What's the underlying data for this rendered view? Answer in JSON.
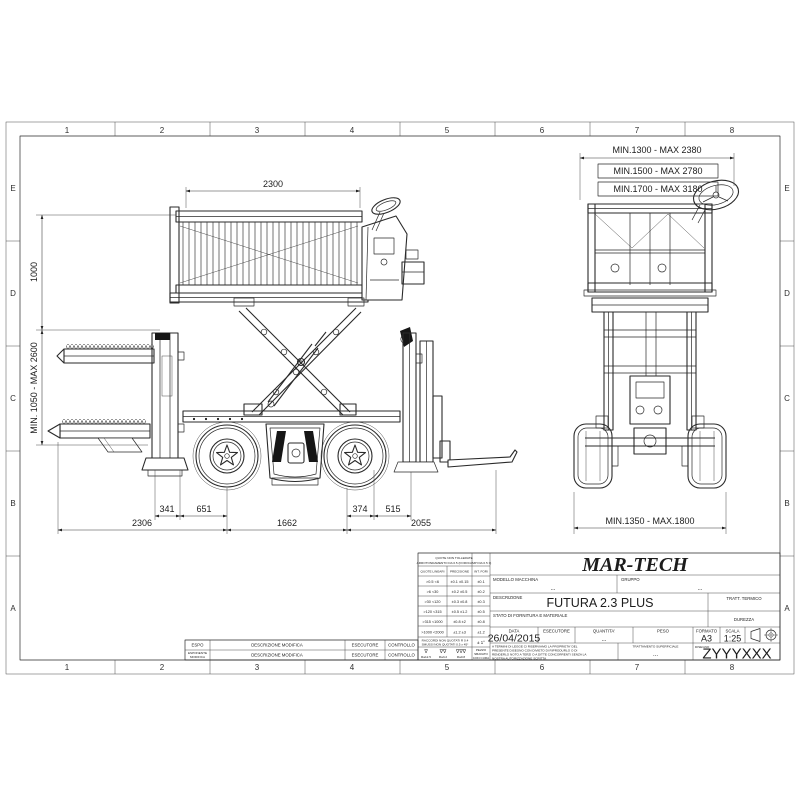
{
  "colors": {
    "line": "#2a2a2a",
    "background": "#ffffff",
    "dark_fill": "#161616"
  },
  "frame": {
    "columns": [
      "1",
      "2",
      "3",
      "4",
      "5",
      "6",
      "7",
      "8"
    ],
    "rows": [
      "E",
      "D",
      "C",
      "B",
      "A"
    ]
  },
  "side_view": {
    "dim_top": "2300",
    "dim_height_upper": "1000",
    "dim_height_lower": "MIN. 1050 - MAX 2600",
    "dim_341": "341",
    "dim_651": "651",
    "dim_374": "374",
    "dim_515": "515",
    "dim_2306": "2306",
    "dim_1662": "1662",
    "dim_2055": "2055"
  },
  "front_view": {
    "dim_top_1": "MIN.1300 - MAX 2380",
    "dim_top_2": "MIN.1500 - MAX 2780",
    "dim_top_3": "MIN.1700 - MAX 3180",
    "dim_bottom": "MIN.1350 - MAX.1800"
  },
  "revision_table": {
    "col_espo": "ESPO",
    "col_espo_sub1": "ESPONENTE",
    "col_espo_sub2": "MODIFICA",
    "col_desc": "DESCRIZIONE MODIFICA",
    "col_exec": "ESECUTORE",
    "col_ctrl": "CONTROLLO"
  },
  "tolerance_table": {
    "header_line1": "QUOTE NON TOLLERATE",
    "header_line2": "ARROTONDAMENTO DA 0.5 (FORI/CAMPI DA 0.5 ±)",
    "col_linear": "QUOTE LINEARI",
    "col_precision": "PRECISIONE",
    "col_holes": "INT. FORI",
    "rows": [
      {
        "range": ">0.5  <6",
        "prec": "±0.1  ±0.15",
        "fori": "±0.1"
      },
      {
        "range": ">6  <30",
        "prec": "±0.2  ±0.5",
        "fori": "±0.2"
      },
      {
        "range": ">30  <120",
        "prec": "±0.3  ±0.8",
        "fori": "±0.3"
      },
      {
        "range": ">120  <315",
        "prec": "±0.5  ±1.2",
        "fori": "±0.5"
      },
      {
        "range": ">315 <1000",
        "prec": "±0.8  ±2",
        "fori": "±0.8"
      },
      {
        "range": ">1000 <2000",
        "prec": "±1.2  ±3",
        "fori": "±1.2"
      }
    ],
    "raccordi_line1": "RACCORDI NON QUOTATI R 0.4",
    "raccordi_line2": "SMUSSI NON QUOTATI 0.5 x 45°",
    "angles_value": "± 1°",
    "roughness": [
      {
        "symbol": "∇",
        "value": "Ra12.5"
      },
      {
        "symbol": "∇∇",
        "value": "Ra3.2"
      },
      {
        "symbol": "∇∇∇",
        "value": "Ra0.8"
      }
    ],
    "deburr_line1": "PEZZO",
    "deburr_line2": "SBAVATO",
    "deburr_line3": "CON CURA"
  },
  "title_block": {
    "company": "MAR-TECH",
    "modello_label": "MODELLO MACCHINA",
    "modello_value": "...",
    "gruppo_label": "GRUPPO",
    "gruppo_value": "...",
    "descrizione_label": "DESCRIZIONE",
    "descrizione_value": "FUTURA 2.3 PLUS",
    "tratt_termico_label": "TRATT. TERMICO",
    "stato_label": "STATO DI FORNITURA E MATERIALE",
    "durezza_label": "DUREZZA",
    "data_label": "DATA",
    "data_value": "26/04/2015",
    "esecutore_label": "ESECUTORE",
    "quantita_label": "QUANTITA'",
    "quantita_value": "...",
    "peso_label": "PESO",
    "formato_label": "FORMATO",
    "formato_value": "A3",
    "scala_label": "SCALA",
    "scala_value": "1:25",
    "legal_line1": "A TERMINI DI LEGGE CI RISERVIAMO LA PROPRIETA' DEL",
    "legal_line2": "PRESENTE DISEGNO CON DIVIETO DI RIPRODURLO O DI",
    "legal_line3": "RENDERLO NOTO A TERZI O A DITTE CONCORRENTI SENZA LA",
    "legal_line4": "NOSTRA AUTORIZZAZIONE SCRITTA",
    "tratt_sup_label": "TRATTAMENTO SUPERFICIALE",
    "tratt_sup_value": "...",
    "disegno_label": "DISEGNO",
    "disegno_value": "ZYYYXXX"
  }
}
